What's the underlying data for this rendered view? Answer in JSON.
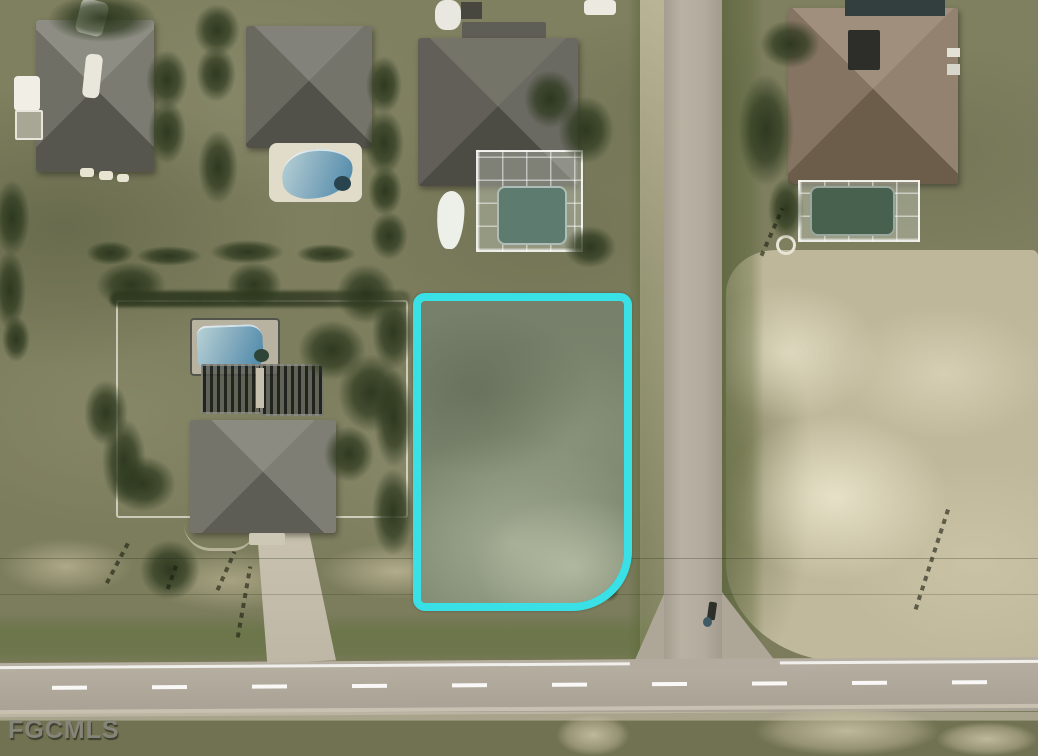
{
  "image": {
    "kind": "aerial satellite photo",
    "subject": "vacant corner lot outlined in cyan among residential homes with pools"
  },
  "watermark": {
    "text": "FGCMLS"
  },
  "lot_highlight": {
    "shape": "rectangular parcel boundary with rounded street corner at bottom-right",
    "outline_color": "#39E1E6"
  },
  "colors": {
    "outline": "#39e1e6",
    "grass": "#7f8060",
    "grassBright": "#6d7950",
    "road": "#b3ac9e",
    "roadShoulder": "#c2baa4",
    "sand": "#bfb79a",
    "sandLight": "#ded7bb",
    "roofGray": "#6e6d65",
    "roofDark": "#53524b",
    "roofBrown": "#8d7d6a",
    "poolBlue": "#6fa9c4",
    "enclosurePool": "#5d7b6f",
    "treeGreen": "#2f3a20",
    "fenceWhite": "#f5f3e8",
    "watermarkGray": "#87877d"
  }
}
